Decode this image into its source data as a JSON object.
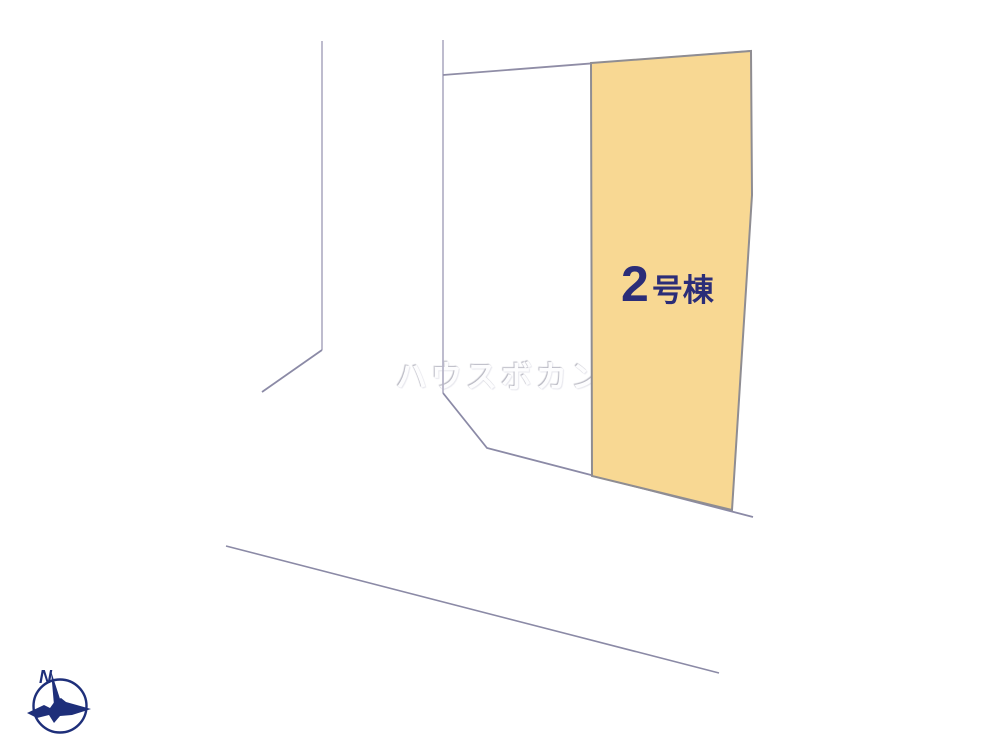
{
  "map": {
    "title": "lot layout diagram",
    "parcel": {
      "label_number": "2",
      "label_suffix": "号棟",
      "label_full": "2号棟",
      "fill_color": "#f8d893",
      "border_color": "#8f8d92",
      "label_color": "#2b2d78"
    },
    "watermark": {
      "text": "ハウスボカン"
    },
    "compass": {
      "north_label": "N",
      "color": "#1e2f7a"
    },
    "colors": {
      "background": "#ffffff",
      "boundary_line_dark": "#8b8aa6",
      "boundary_line_light": "#b7b5c8"
    }
  }
}
